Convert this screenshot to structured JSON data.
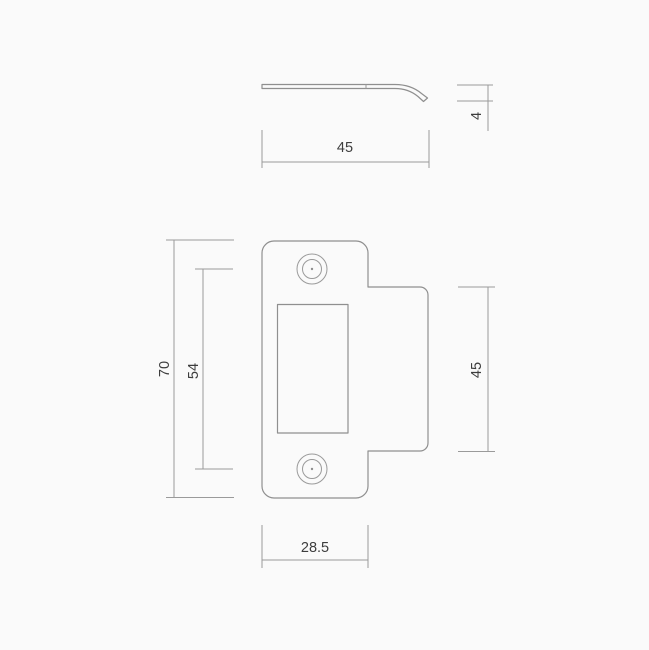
{
  "drawing": {
    "subject": "strike-plate-technical-drawing",
    "background_color": "#fafafa",
    "line_color": "#8f8f8f",
    "dimension_line_color": "#9a9a9a",
    "text_color": "#3d3d3d"
  },
  "dimensions": {
    "profile_overall_width": "45",
    "profile_lip_height": "4",
    "front_overall_height": "70",
    "front_hole_spacing": "54",
    "front_tab_height": "45",
    "front_body_width": "28.5"
  }
}
